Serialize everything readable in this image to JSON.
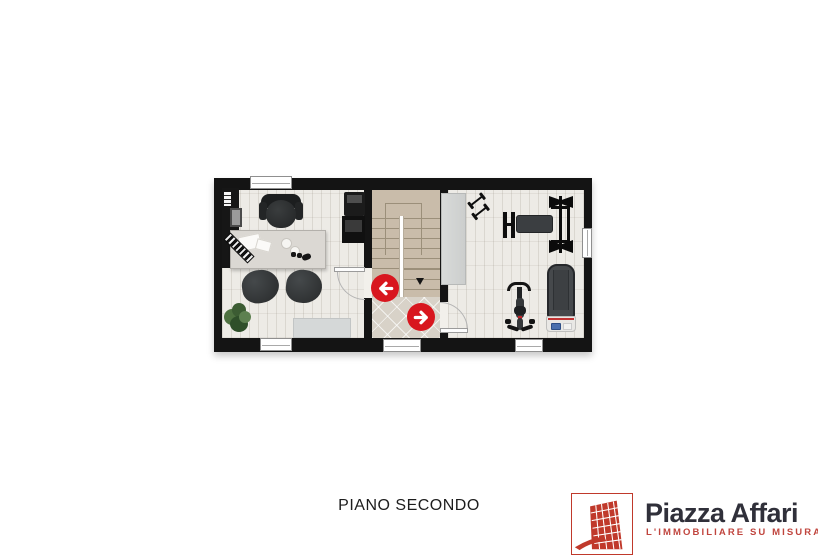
{
  "floor_label": "PIANO SECONDO",
  "brand": {
    "name": "Piazza Affari",
    "tagline": "L'IMMOBILIARE SU MISURA",
    "logo_icon": "red-grid-tower-icon",
    "accent_red": "#c0392b",
    "text_dark": "#30303a"
  },
  "colors": {
    "wall": "#141414",
    "wood_floor": "#edebe6",
    "stairs": "#c9bcaa",
    "landing_tiles": "#d8d2c8",
    "nav_arrow_red": "#d8161e"
  },
  "plan": {
    "rooms": [
      {
        "id": "office",
        "items": [
          "bookshelf",
          "office chair",
          "desk",
          "printer",
          "armchair",
          "armchair",
          "plant",
          "rug"
        ]
      },
      {
        "id": "stairwell",
        "items": [
          "staircase",
          "tiled landing"
        ]
      },
      {
        "id": "gym",
        "items": [
          "wardrobe",
          "dumbbells",
          "bench press",
          "exercise bike",
          "treadmill"
        ]
      }
    ],
    "windows": 5,
    "doors": 2,
    "navigation_arrows": [
      {
        "direction": "left"
      },
      {
        "direction": "right"
      }
    ]
  }
}
